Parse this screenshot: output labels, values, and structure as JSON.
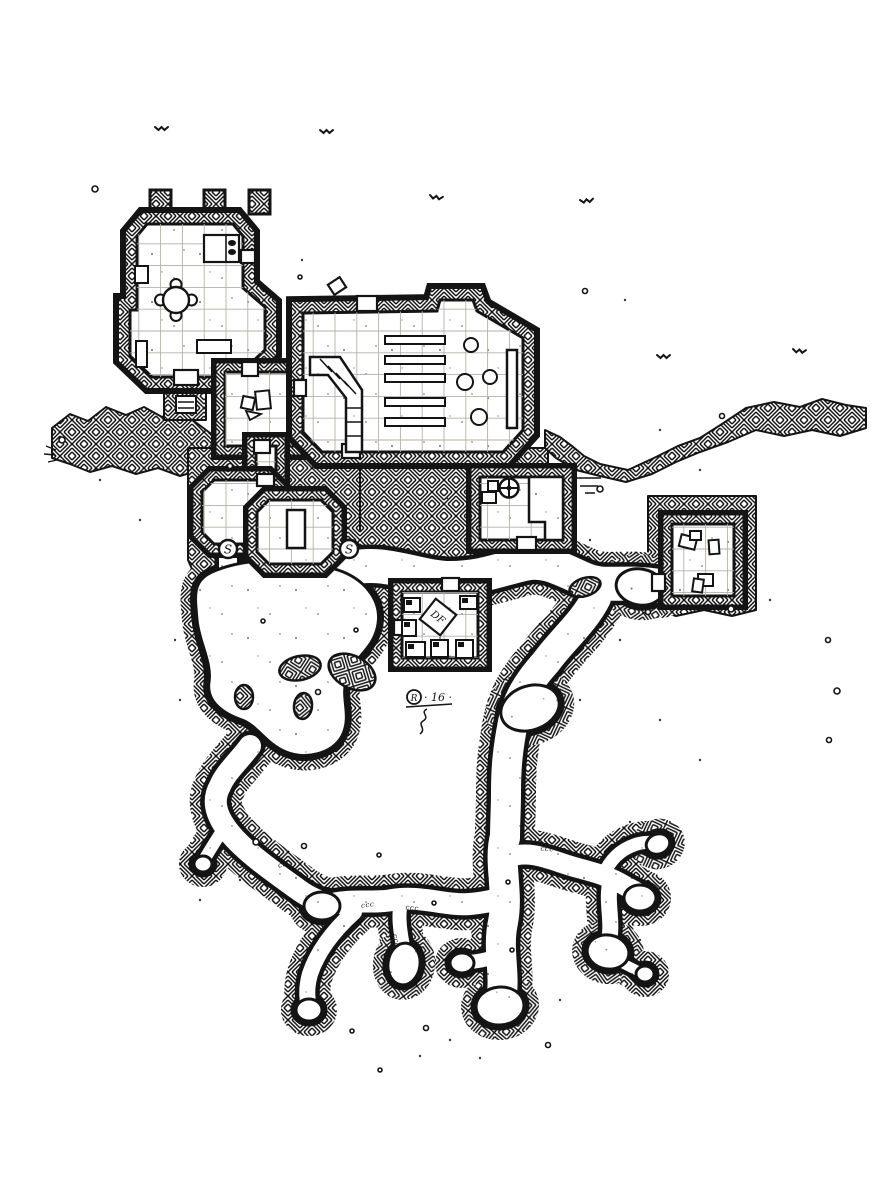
{
  "annotations": {
    "secret_door_left": "S",
    "secret_door_right": "S",
    "sigil_letter": "R",
    "sigil_scale": "· 16 ·",
    "table_monogram": "DF",
    "steps_mark": "ccc"
  },
  "palette": {
    "ink": "#141414",
    "paper": "#ffffff",
    "grid": "#b7b0a3"
  }
}
